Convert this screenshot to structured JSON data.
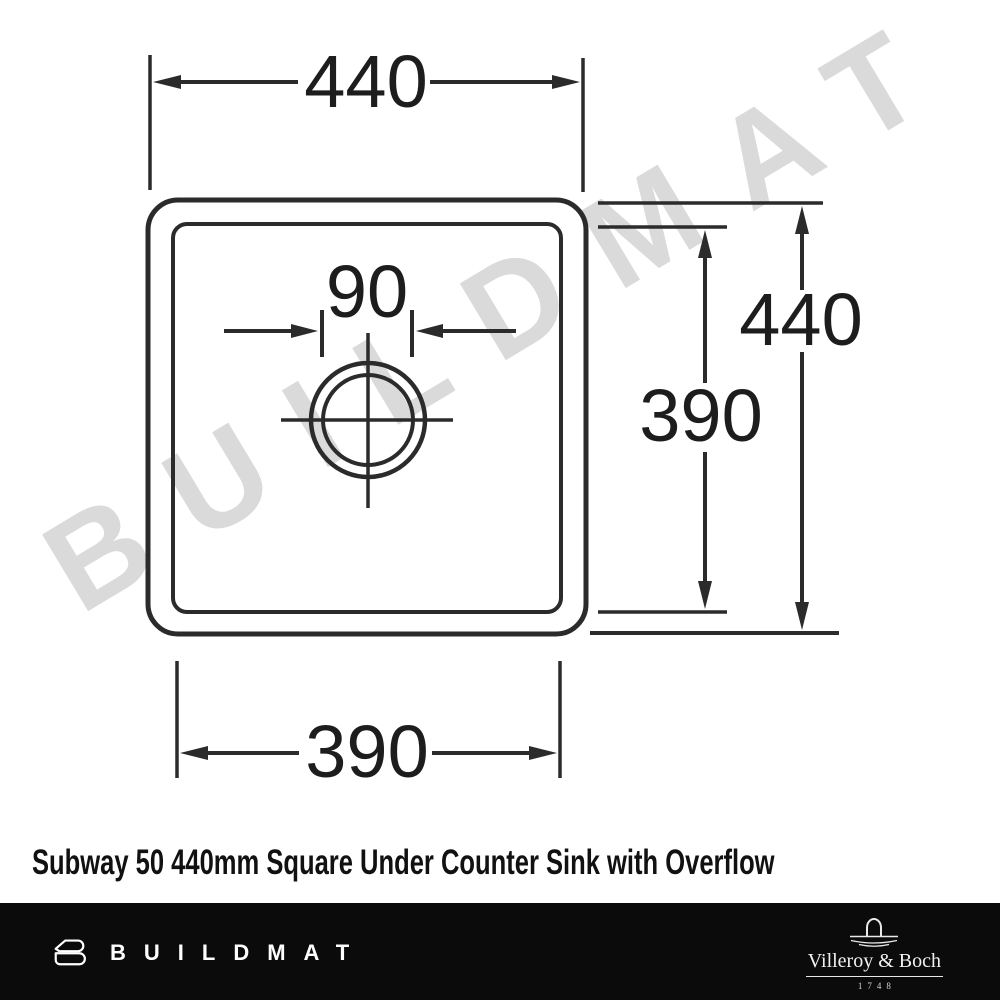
{
  "watermark": {
    "text": "BUILDMAT",
    "color": "#dadada"
  },
  "drawing": {
    "dims": {
      "overall_width": "440",
      "overall_height": "440",
      "bowl_height": "390",
      "bowl_width": "390",
      "drain_diameter": "90"
    },
    "line_color": "#2b2b2b"
  },
  "title": "Subway 50 440mm Square Under Counter Sink with Overflow",
  "footer": {
    "bar_color": "#0b0b0b",
    "brand": "BUILDMAT",
    "manufacturer": {
      "name": "Villeroy & Boch",
      "year": "1748"
    }
  }
}
